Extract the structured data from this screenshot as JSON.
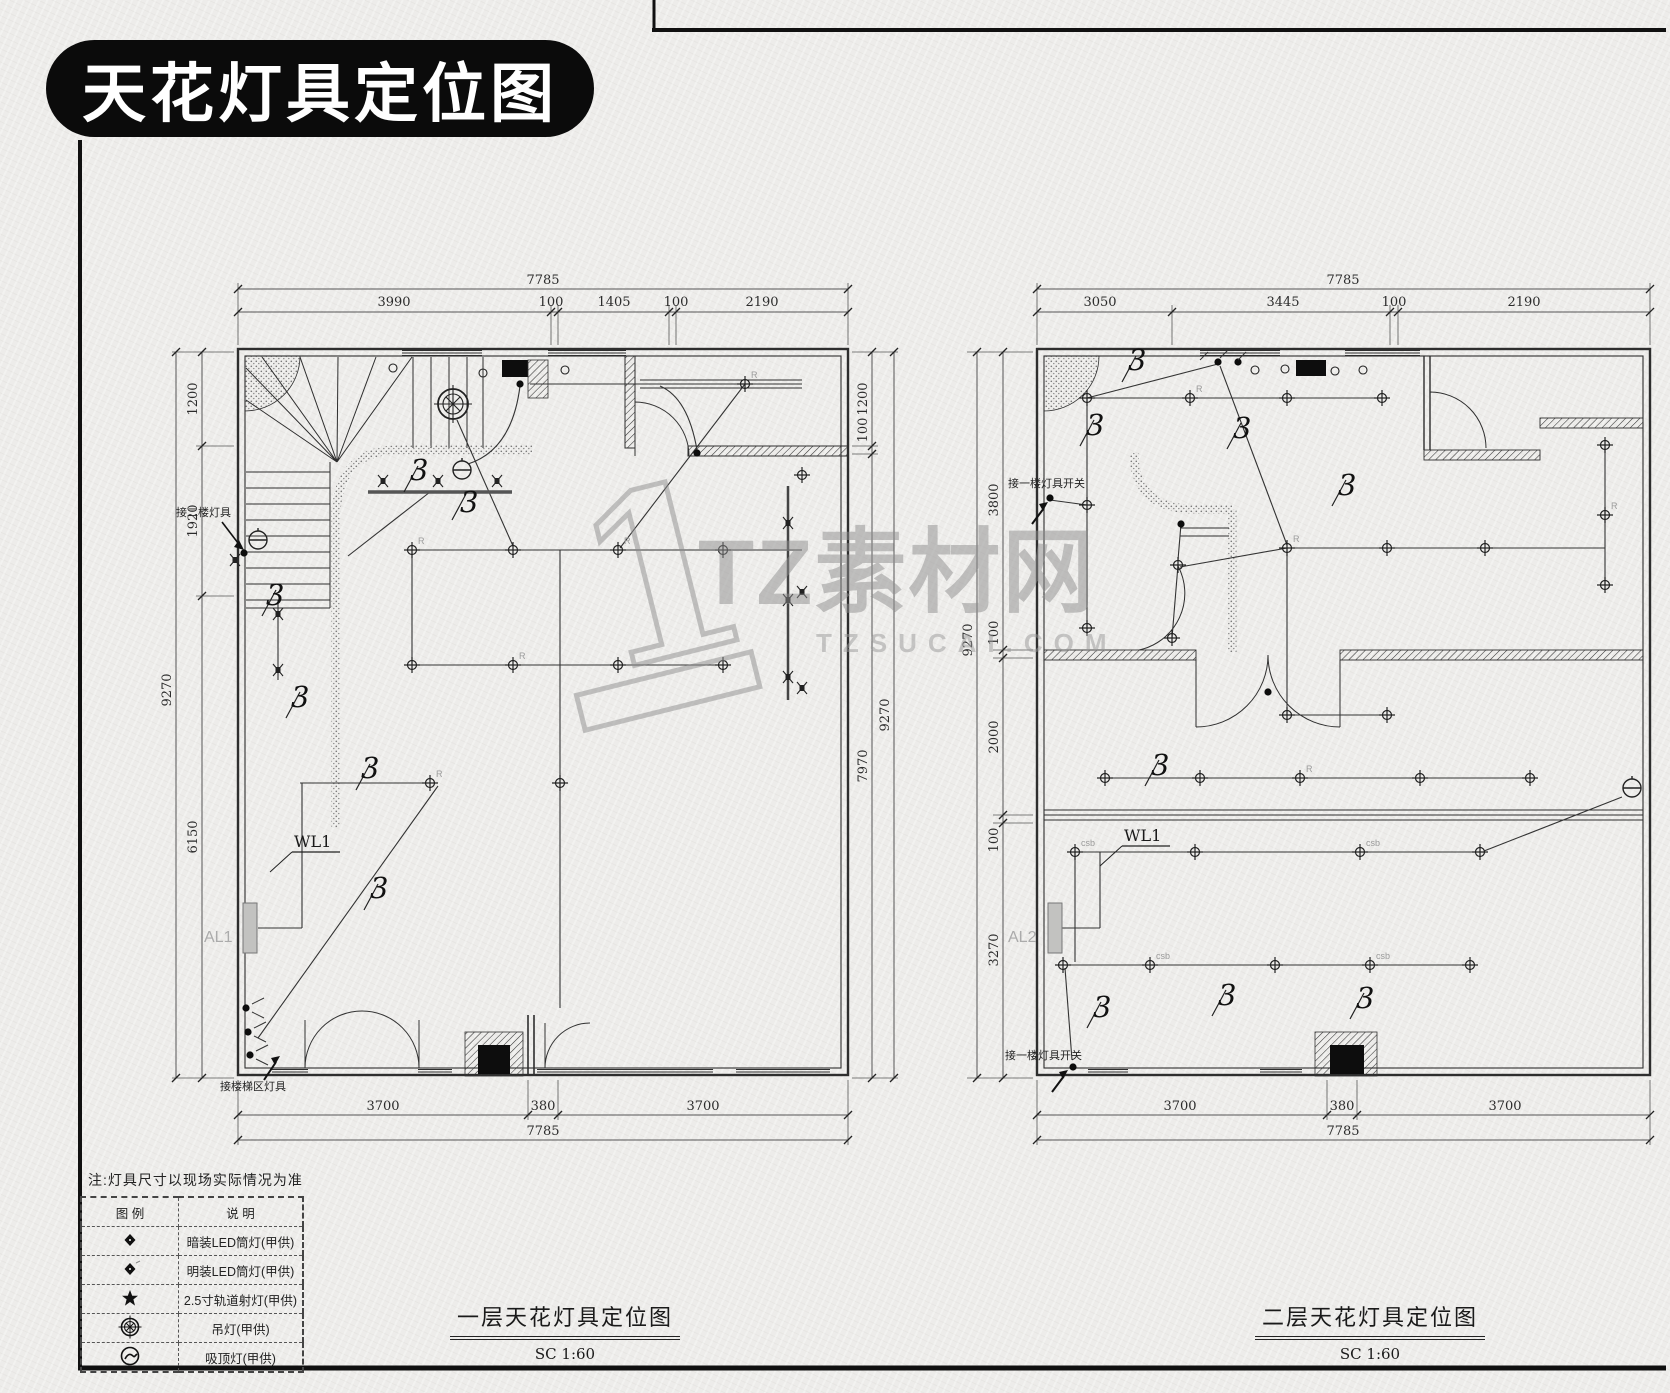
{
  "banner": {
    "title": "天花灯具定位图"
  },
  "watermark": {
    "logo_numeral": "1",
    "brand": "TZ素材网",
    "domain": "TZSUCAI.COM"
  },
  "note": "注:灯具尺寸以现场实际情况为准",
  "legend": {
    "col_symbol": "图 例",
    "col_desc": "说 明",
    "rows": [
      {
        "icon": "recessed-led-downlight-icon",
        "desc": "暗装LED筒灯(甲供)"
      },
      {
        "icon": "surface-led-downlight-icon",
        "desc": "明装LED筒灯(甲供)"
      },
      {
        "icon": "track-spotlight-icon",
        "desc": "2.5寸轨道射灯(甲供)"
      },
      {
        "icon": "pendant-light-icon",
        "desc": "吊灯(甲供)"
      },
      {
        "icon": "ceiling-lamp-icon",
        "desc": "吸顶灯(甲供)"
      }
    ]
  },
  "plans": {
    "first": {
      "title": "一层天花灯具定位图",
      "scale": "SC  1:60",
      "circuit": "3",
      "panel": "AL1",
      "wire_label": "WL1",
      "ann_second_floor": "接二楼灯具",
      "ann_stair": "接楼梯区灯具",
      "light_code": "R",
      "dims": {
        "top_total": "7785",
        "top": [
          "3990",
          "100",
          "1405",
          "100",
          "2190"
        ],
        "bottom": [
          "3700",
          "380",
          "3700"
        ],
        "bottom_total": "7785",
        "left": [
          "1200",
          "1920",
          "6150"
        ],
        "left_total": "9270",
        "right": [
          "1200",
          "100",
          "7970"
        ],
        "right_total": "9270"
      }
    },
    "second": {
      "title": "二层天花灯具定位图",
      "scale": "SC  1:60",
      "circuit": "3",
      "panel": "AL2",
      "wire_label": "WL1",
      "ann_switch": "接一楼灯具开关",
      "light_code": "R",
      "light_code_cob": "csb",
      "dims": {
        "top_total": "7785",
        "top": [
          "3050",
          "3445",
          "100",
          "2190"
        ],
        "bottom": [
          "3700",
          "380",
          "3700"
        ],
        "bottom_total": "7785",
        "left": [
          "3800",
          "100",
          "2000",
          "100",
          "3270"
        ],
        "left_total": "9270"
      }
    }
  }
}
